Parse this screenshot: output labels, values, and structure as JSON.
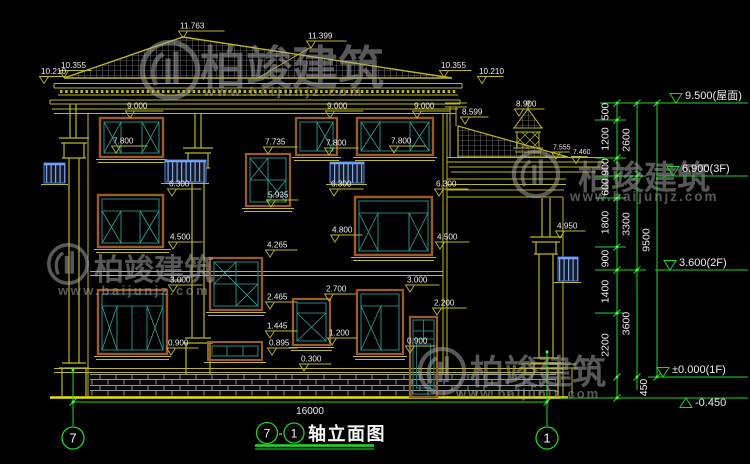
{
  "watermark": {
    "brand": "柏竣建筑",
    "url": "www.baijunjz.com"
  },
  "drawing_title": {
    "axis_start": "7",
    "separator": "-",
    "axis_end": "1",
    "name": "轴立面图"
  },
  "grid_labels": {
    "left": "7",
    "right": "1"
  },
  "dimensions": {
    "total_width": "16000",
    "chain_inner": [
      "500",
      "1200",
      "900",
      "600",
      "1800",
      "900",
      "1400",
      "2200",
      "450"
    ],
    "chain_mid": [
      "2600",
      "3300",
      "3600"
    ],
    "chain_outer": [
      "9500"
    ]
  },
  "levels": [
    {
      "label": "9.500(屋面)"
    },
    {
      "label": "6.900(3F)"
    },
    {
      "label": "3.600(2F)"
    },
    {
      "label": "±0.000(1F)"
    },
    {
      "label": "-0.450"
    }
  ],
  "elevations": {
    "e11763": "11.763",
    "e11399": "11.399",
    "e10355L": "10.355",
    "e10210L": "10.210",
    "e10355R": "10.355",
    "e10210R": "10.210",
    "e9000a": "9.000",
    "e9000b": "9.000",
    "e9000c": "9.000",
    "e8900": "8.900",
    "e8599": "8.599",
    "e7800a": "7.800",
    "e7800b": "7.800",
    "e7800c": "7.800",
    "e7735": "7.735",
    "e7555": "7.555",
    "e7460": "7.460",
    "e6300a": "6.300",
    "e6300b": "6.300",
    "e6300c": "6.300",
    "e5935": "5.935",
    "e4950": "4.950",
    "e4800": "4.800",
    "e4500a": "4.500",
    "e4500b": "4.500",
    "e4265": "4.265",
    "e3000a": "3.000",
    "e3000b": "3.000",
    "e2700": "2.700",
    "e2465": "2.465",
    "e2200": "2.200",
    "e1445": "1.445",
    "e1200": "1.200",
    "e0900a": "0.900",
    "e0900b": "0.900",
    "e0895": "0.895",
    "e0300": "0.300"
  }
}
